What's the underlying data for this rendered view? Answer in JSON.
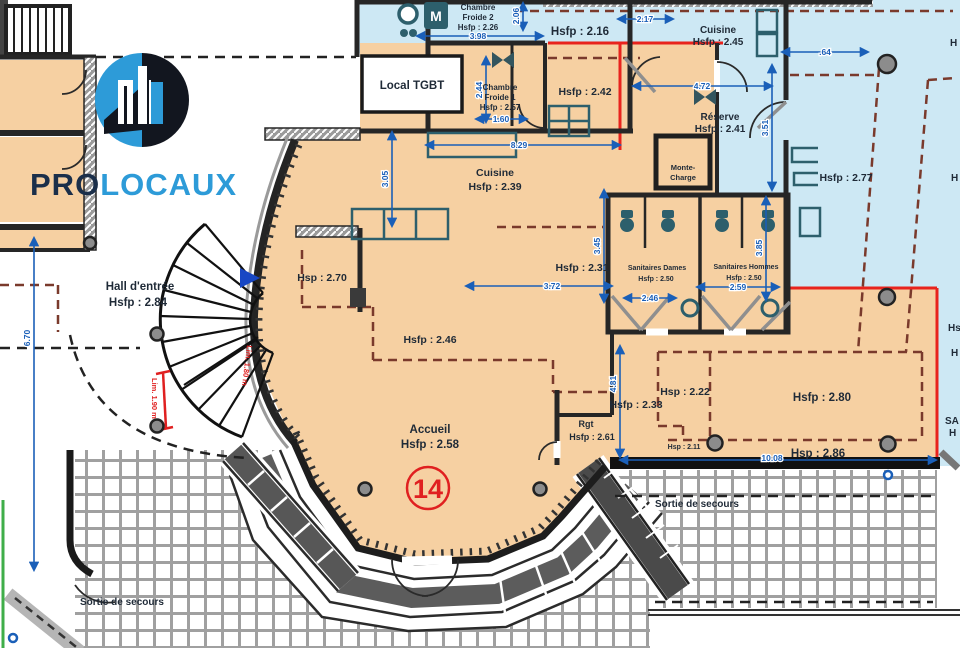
{
  "logo": {
    "pro": "PRO",
    "locaux": "LOCAUX"
  },
  "rooms": {
    "cf2": {
      "l1": "Chambre",
      "l2": "Froide 2",
      "l3": "Hsfp : 2.26"
    },
    "z216": "Hsfp : 2.16",
    "cuisine45": {
      "l1": "Cuisine",
      "l2": "Hsfp : 2.45"
    },
    "tgbt": "Local TGBT",
    "cf1": {
      "l1": "Chambre",
      "l2": "Froide 1",
      "l3": "Hsfp : 2.57"
    },
    "z242": "Hsfp : 2.42",
    "reserve": {
      "l1": "Réserve",
      "l2": "Hsfp : 2.41"
    },
    "monte": {
      "l1": "Monte-",
      "l2": "Charge"
    },
    "z277": "Hsfp : 2.77",
    "cuisine39": {
      "l1": "Cuisine",
      "l2": "Hsfp : 2.39"
    },
    "hall": {
      "l1": "Hall d'entrée",
      "l2": "Hsfp : 2.84"
    },
    "z270": "Hsp : 2.70",
    "z231": "Hsfp : 2.31",
    "dames": {
      "l1": "Sanitaires Dames",
      "l2": "Hsfp : 2.50"
    },
    "hommes": {
      "l1": "Sanitaires Hommes",
      "l2": "Hsfp : 2.50"
    },
    "z246": "Hsfp : 2.46",
    "z233": "Hsfp : 2.33",
    "z222": "Hsp : 2.22",
    "z211": "Hsp : 2.11",
    "z280": "Hsfp : 2.80",
    "z286": "Hsp : 2.86",
    "rgt": {
      "l1": "Rgt",
      "l2": "Hsfp : 2.61"
    },
    "accueil": {
      "l1": "Accueil",
      "l2": "Hsfp : 2.58"
    },
    "number": "14",
    "sortie_left": "Sortie de secours",
    "sortie_right": "Sortie de secours",
    "lim_left": "Lim. 1.90 m",
    "lim_right": "Lim. 1.80 m"
  },
  "frags": {
    "f1": "H",
    "f2": "H",
    "f3": "Hs",
    "f4": "H",
    "f5": "SA",
    "f6": "H"
  },
  "dims": {
    "d398": "3.98",
    "d206": "2.06",
    "d217": "2.17",
    "d064": ".64",
    "d472": "4.72",
    "d244": "2.44",
    "d160": "1.60",
    "d829": "8.29",
    "d305": "3.05",
    "d372": "3.72",
    "d345": "3.45",
    "d246": "2.46",
    "d259": "2.59",
    "d385": "3.85",
    "d670": "6.70",
    "d481": "4.81",
    "d1008": "10.08",
    "d351": "3.51"
  },
  "icons": {
    "m_unit": "M"
  },
  "colors": {
    "floor_peach": "#f6d0a2",
    "zone_blue": "#cde8f4",
    "wall_dark": "#262626",
    "dim_blue": "#1a5fb8",
    "accent_red": "#e8231d",
    "dash_brown": "#7a3a2c",
    "fixture_teal": "#2d5f6c",
    "logo_blue": "#2d9bd8",
    "logo_dark": "#12161f",
    "tile_gray": "#a0a0a0",
    "step_gray": "#5c5c5c",
    "marker_blue": "#1847c4"
  }
}
